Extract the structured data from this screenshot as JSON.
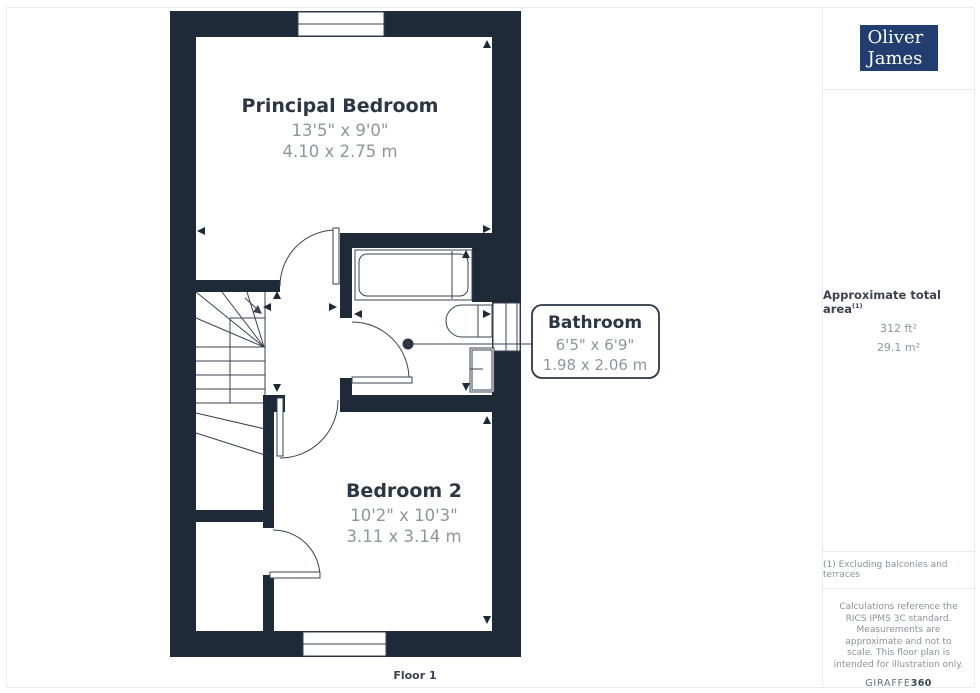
{
  "page": {
    "floor_label": "Floor 1"
  },
  "floorplan": {
    "rooms": [
      {
        "name": "Principal Bedroom",
        "imperial": "13'5\" x 9'0\"",
        "metric": "4.10 x 2.75 m"
      },
      {
        "name": "Bathroom",
        "imperial": "6'5\" x 6'9\"",
        "metric": "1.98 x 2.06 m"
      },
      {
        "name": "Bedroom 2",
        "imperial": "10'2\" x 10'3\"",
        "metric": "3.11 x 3.14 m"
      }
    ]
  },
  "sidebar": {
    "logo": {
      "line1": "Oliver",
      "line2": "James"
    },
    "area": {
      "label": "Approximate total area",
      "footnote_marker": "(1)",
      "imperial": "312 ft²",
      "metric": "29.1 m²"
    },
    "footnote": "(1) Excluding balconies and terraces",
    "disclaimer": "Calculations reference the RICS IPMS 3C standard. Measurements are approximate and not to scale. This floor plan is intended for illustration only.",
    "brand": {
      "name": "GIRAFFE",
      "suffix": "360"
    }
  },
  "colors": {
    "wall": "#1f2a39",
    "logo_blue": "#223d6f",
    "label_dark": "#2d3643",
    "label_gray": "#8f959e",
    "divider": "#e8eaed"
  }
}
